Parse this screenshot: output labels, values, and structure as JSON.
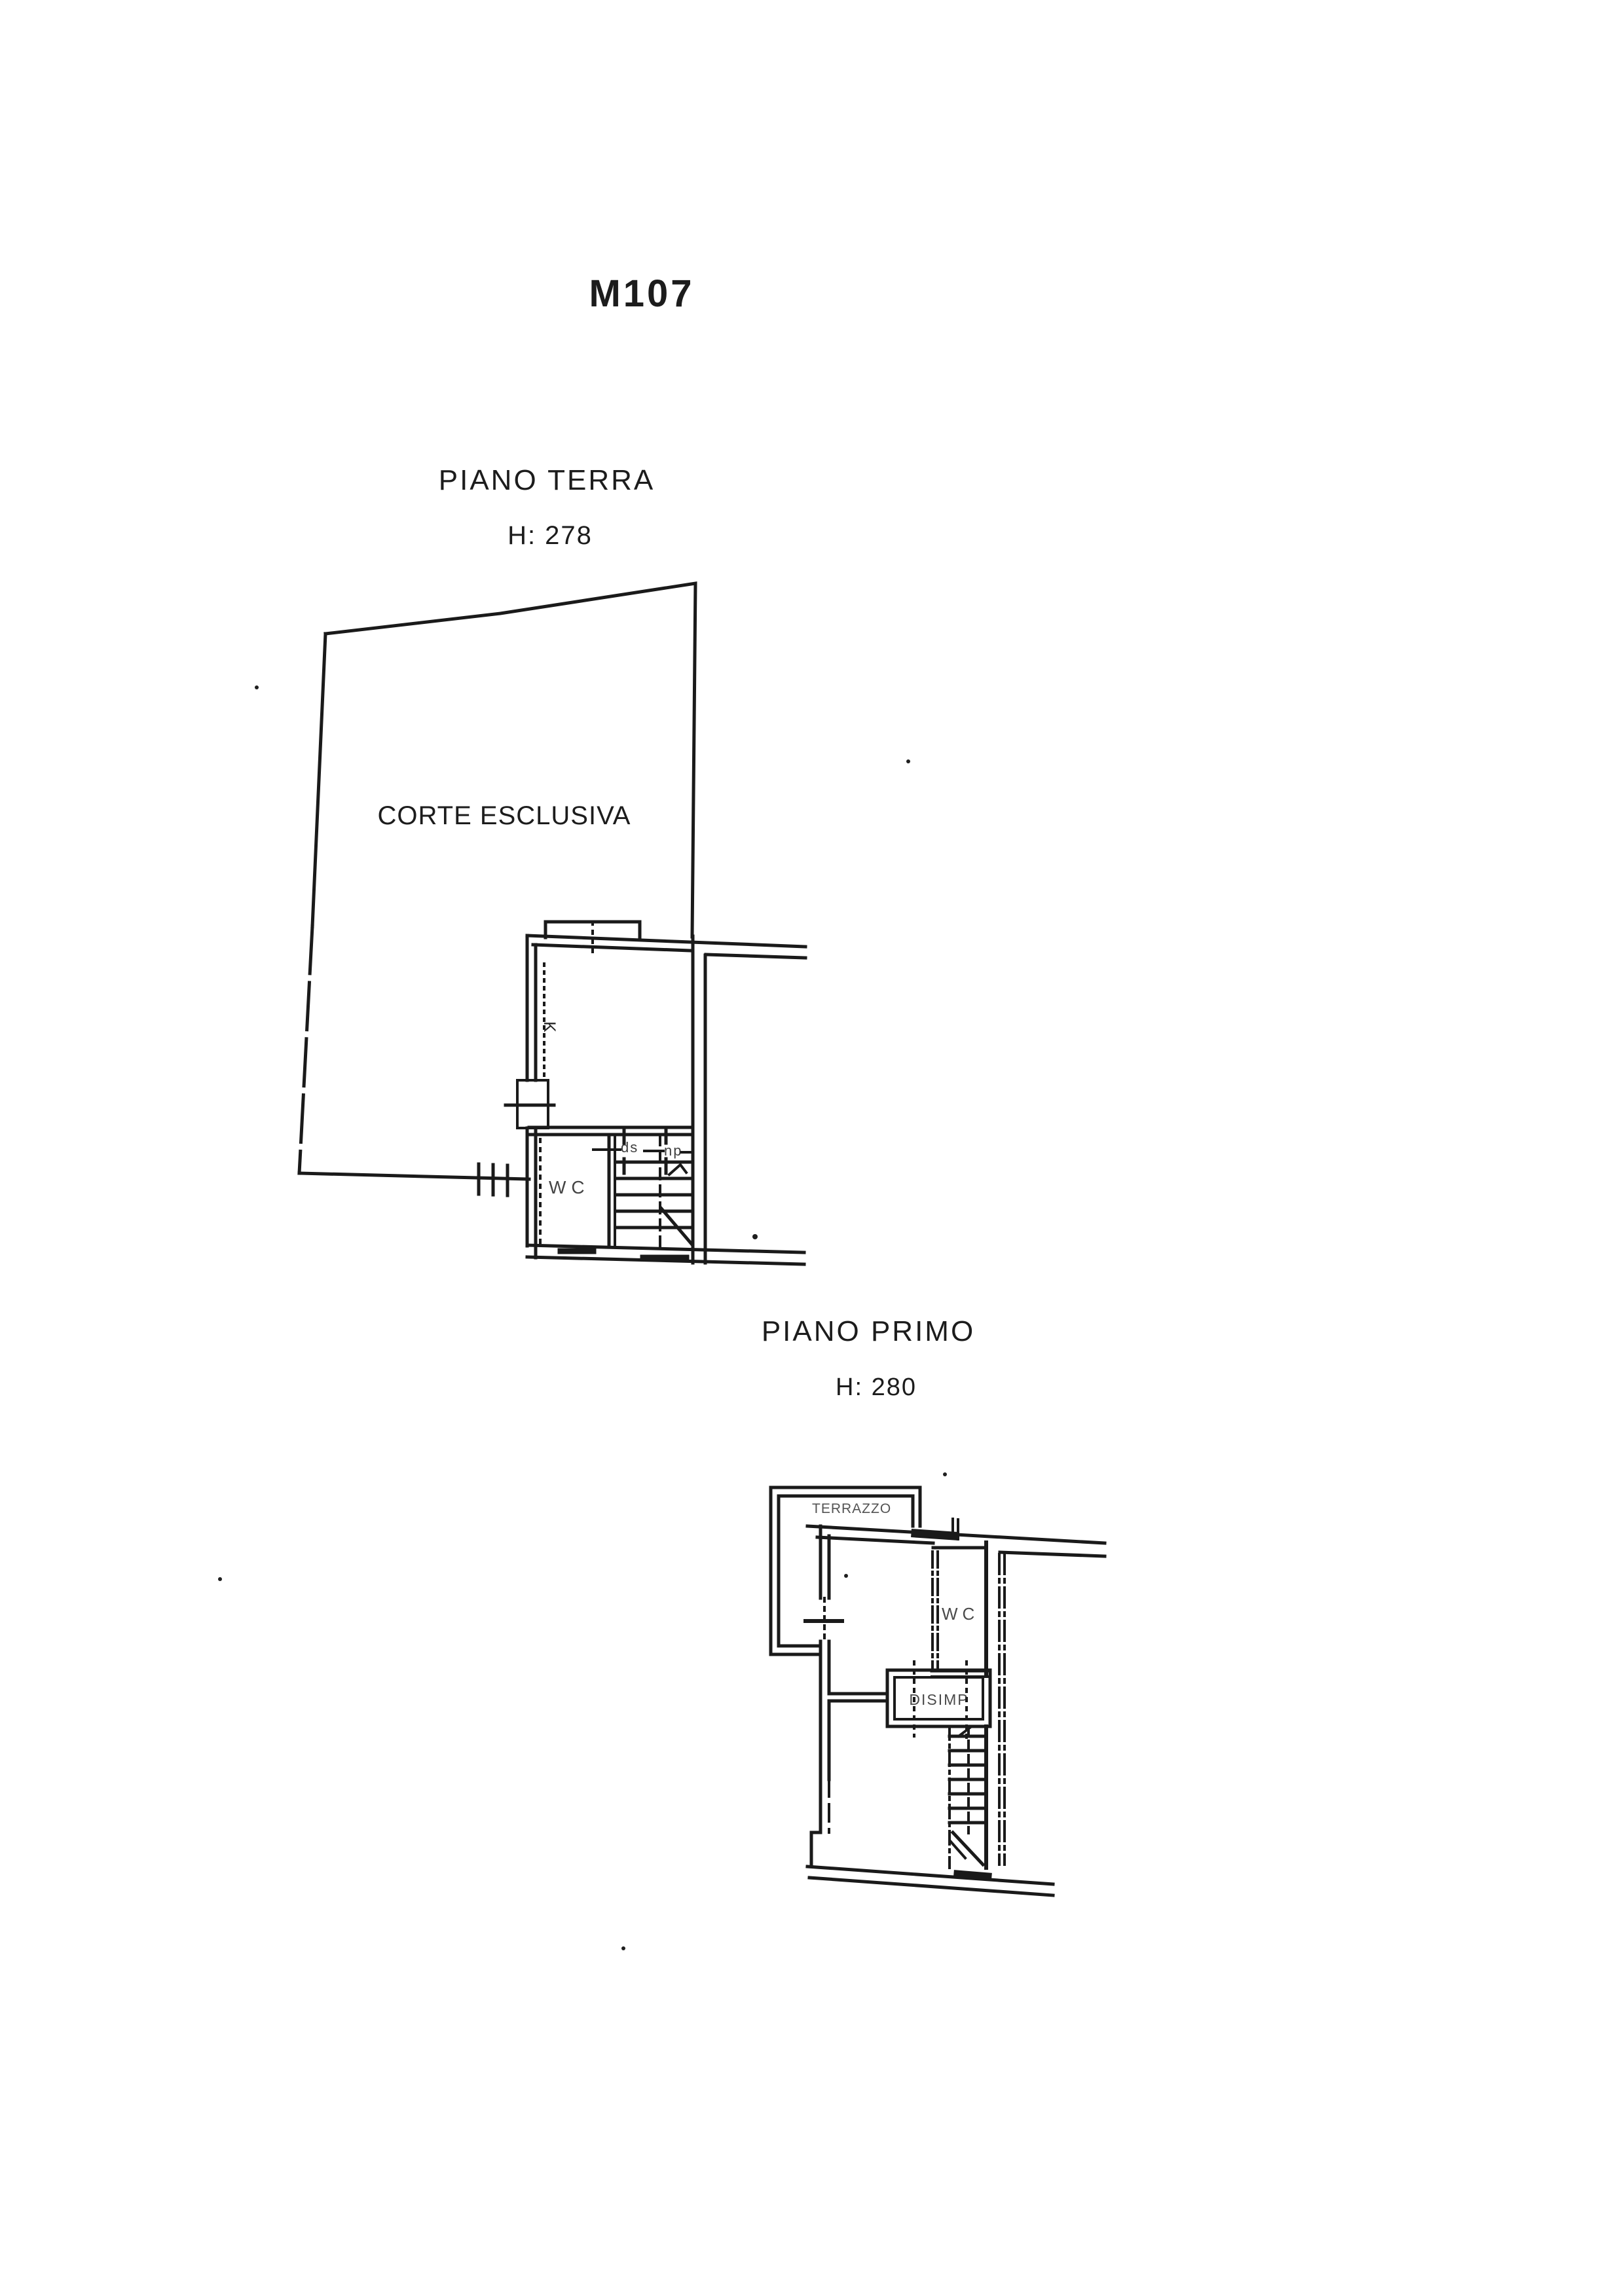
{
  "colors": {
    "paper": "#ffffff",
    "ink": "#1a1a1a"
  },
  "page": {
    "code_label": "M107"
  },
  "ground_floor": {
    "title": "PIANO TERRA",
    "height": "H: 278",
    "courtyard_label": "CORTE ESCLUSIVA",
    "kitchen_label": "K",
    "wc_label": "WC",
    "stair_label_left": "ds",
    "stair_label_right": "np"
  },
  "first_floor": {
    "title": "PIANO PRIMO",
    "height": "H: 280",
    "terrace_label": "TERRAZZO",
    "wc_label": "WC",
    "hall_label": "DISIMP"
  }
}
